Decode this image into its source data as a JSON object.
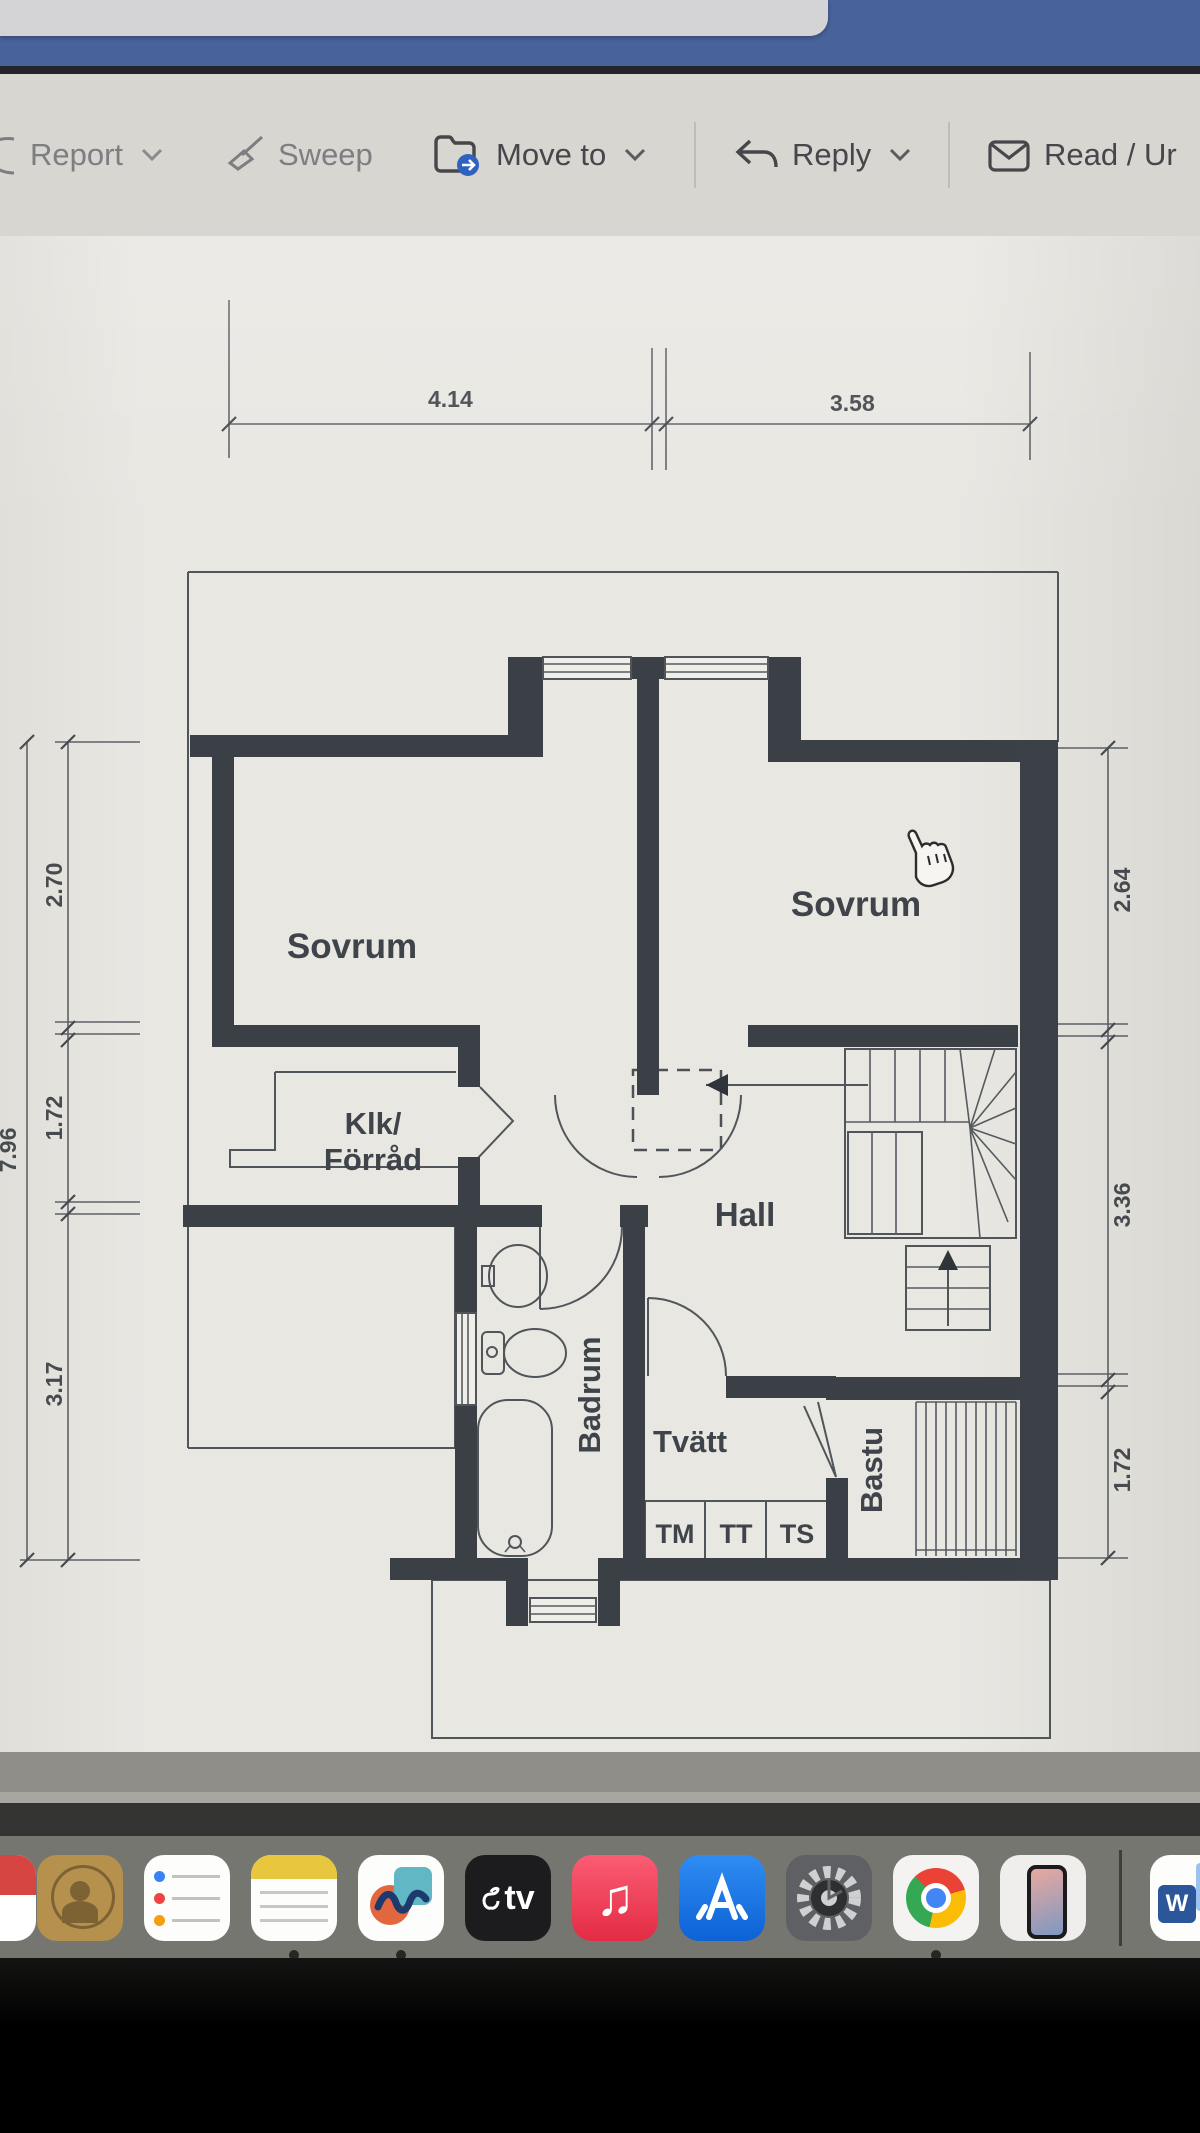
{
  "toolbar": {
    "report": "Report",
    "sweep": "Sweep",
    "move_to": "Move to",
    "reply": "Reply",
    "read": "Read / Ur"
  },
  "plan": {
    "rooms": {
      "sovrum_left": "Sovrum",
      "sovrum_right": "Sovrum",
      "klk_line1": "Klk/",
      "klk_line2": "Förråd",
      "hall": "Hall",
      "badrum": "Badrum",
      "tvatt": "Tvätt",
      "bastu": "Bastu"
    },
    "appliances": {
      "tm": "TM",
      "tt": "TT",
      "ts": "TS"
    },
    "dimensions": {
      "top_1": "4.14",
      "top_2": "3.58",
      "left_1": "2.70",
      "left_2": "1.72",
      "left_3": "3.17",
      "left_total": "7.96",
      "right_1": "2.64",
      "right_2": "3.36",
      "right_3": "1.72"
    },
    "colors": {
      "wall": "#3a4046",
      "paper": "#e9e7e2"
    }
  },
  "dock": {
    "appletv_label": "tv",
    "word_label": "W",
    "apps": [
      "clipped-app",
      "contacts",
      "reminders",
      "notes",
      "freeform",
      "apple-tv",
      "music",
      "app-store",
      "settings",
      "chrome",
      "iphone-mirroring",
      "word"
    ]
  }
}
